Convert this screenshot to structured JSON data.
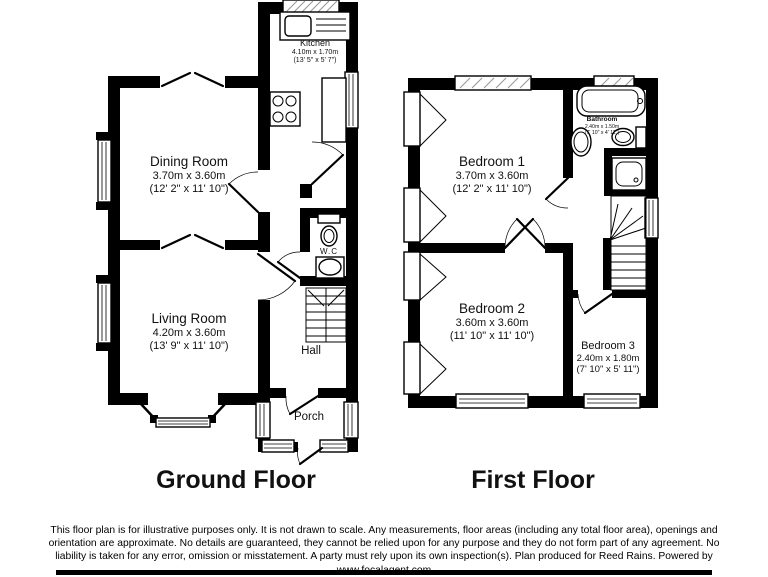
{
  "colors": {
    "wall": "#000000",
    "background": "#ffffff",
    "window_hatch": "#9a9a9a"
  },
  "titles": {
    "ground": "Ground Floor",
    "first": "First Floor"
  },
  "rooms": {
    "kitchen": {
      "name": "Kitchen",
      "metric": "4.10m x 1.70m",
      "imperial": "(13' 5\" x 5' 7\")"
    },
    "dining": {
      "name": "Dining Room",
      "metric": "3.70m x 3.60m",
      "imperial": "(12' 2\" x 11' 10\")"
    },
    "living": {
      "name": "Living Room",
      "metric": "4.20m x 3.60m",
      "imperial": "(13' 9\" x 11' 10\")"
    },
    "wc": {
      "name": "W.C"
    },
    "hall": {
      "name": "Hall"
    },
    "porch": {
      "name": "Porch"
    },
    "bedroom1": {
      "name": "Bedroom 1",
      "metric": "3.70m x 3.60m",
      "imperial": "(12' 2\" x 11' 10\")"
    },
    "bathroom": {
      "name": "Bathroom",
      "metric": "2.40m x 1.50m",
      "imperial": "(7' 10\" x 4' 11\")"
    },
    "bedroom2": {
      "name": "Bedroom 2",
      "metric": "3.60m x 3.60m",
      "imperial": "(11' 10\" x 11' 10\")"
    },
    "bedroom3": {
      "name": "Bedroom 3",
      "metric": "2.40m x 1.80m",
      "imperial": "(7' 10\" x 5' 11\")"
    }
  },
  "disclaimer": {
    "text": "This floor plan is for illustrative purposes only. It is not drawn to scale. Any measurements, floor areas (including any total floor area), openings and orientation are approximate. No details are guaranteed, they cannot be relied upon for any purpose and they do not form part of any agreement. No liability is taken for any error, omission or misstatement. A party must rely upon its own inspection(s). Plan produced for Reed Rains. Powered by www.focalagent.com"
  }
}
